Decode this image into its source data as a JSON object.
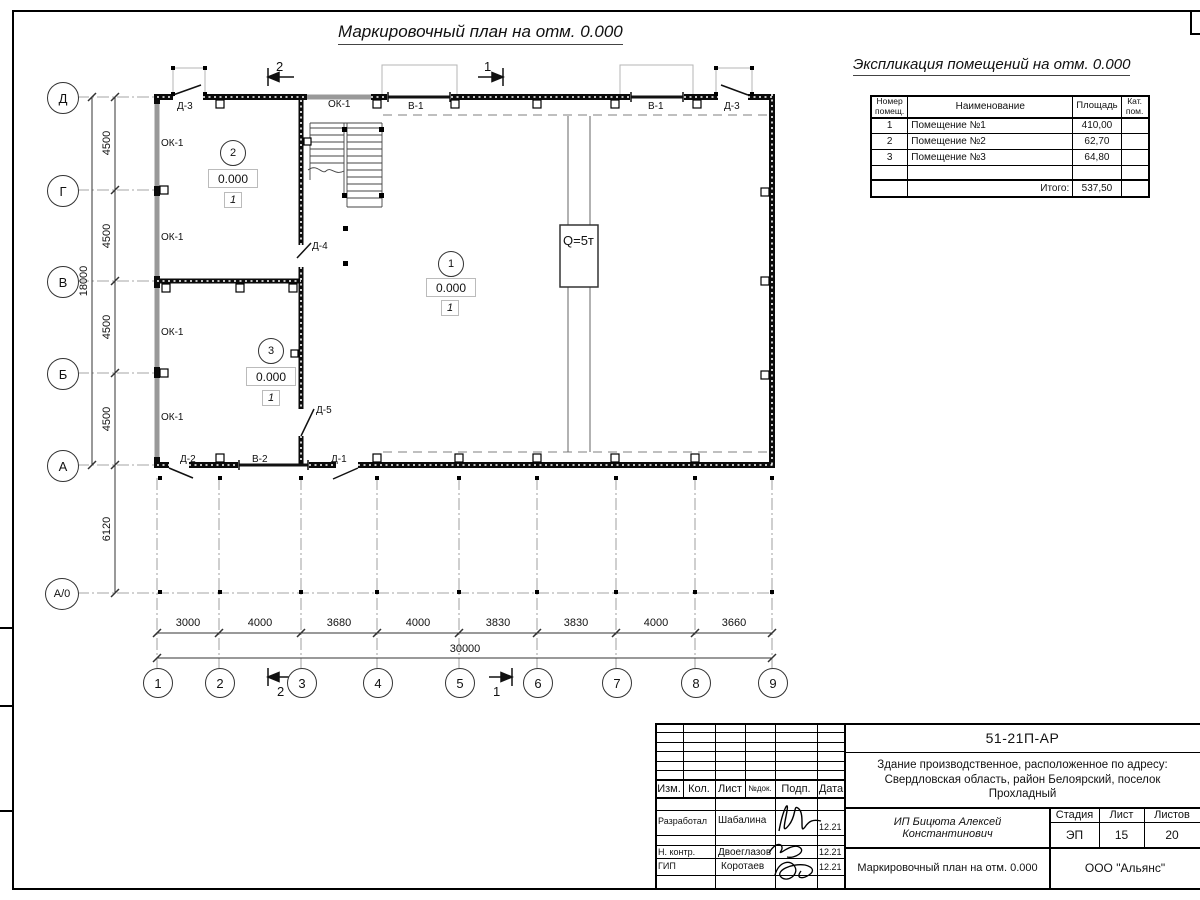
{
  "sheet": {
    "title": "Маркировочный план на отм. 0.000",
    "explication_title": "Экспликация помещений на отм. 0.000"
  },
  "explication": {
    "headers": {
      "num": "Номер помещ.",
      "name": "Наименование",
      "area": "Площадь",
      "cat": "Кат. пом."
    },
    "rows": [
      {
        "num": "1",
        "name": "Помещение №1",
        "area": "410,00",
        "cat": ""
      },
      {
        "num": "2",
        "name": "Помещение №2",
        "area": "62,70",
        "cat": ""
      },
      {
        "num": "3",
        "name": "Помещение №3",
        "area": "64,80",
        "cat": ""
      }
    ],
    "total_label": "Итого:",
    "total_area": "537,50"
  },
  "axes": {
    "rows": [
      "Д",
      "Г",
      "В",
      "Б",
      "А",
      "А/0"
    ],
    "cols": [
      "1",
      "2",
      "3",
      "4",
      "5",
      "6",
      "7",
      "8",
      "9"
    ]
  },
  "dims": {
    "left_bays": [
      "4500",
      "4500",
      "4500",
      "4500"
    ],
    "left_total": "18000",
    "left_offset": "6120",
    "bottom_bays": [
      "3000",
      "4000",
      "3680",
      "4000",
      "3830",
      "3830",
      "4000",
      "3660"
    ],
    "bottom_total": "30000"
  },
  "sections": {
    "s1": "1",
    "s2": "2"
  },
  "rooms": {
    "r1": {
      "num": "1",
      "elev": "0.000",
      "cat": "1"
    },
    "r2": {
      "num": "2",
      "elev": "0.000",
      "cat": "1"
    },
    "r3": {
      "num": "3",
      "elev": "0.000",
      "cat": "1"
    }
  },
  "labels": {
    "ok1": "ОК-1",
    "v1": "В-1",
    "v2": "В-2",
    "d1": "Д-1",
    "d2": "Д-2",
    "d3": "Д-3",
    "d4": "Д-4",
    "d5": "Д-5",
    "crane": "Q=5т"
  },
  "title_block": {
    "doc_number": "51-21П-АР",
    "project": "Здание производственное, расположенное по адресу: Свердловская область, район Белоярский, поселок Прохладный",
    "client": "ИП Бицюта Алексей Константинович",
    "drawing_name": "Маркировочный план на отм. 0.000",
    "company": "ООО \"Альянс\"",
    "stage_label": "Стадия",
    "sheet_label": "Лист",
    "sheets_label": "Листов",
    "stage": "ЭП",
    "sheet_num": "15",
    "sheets_total": "20",
    "cols": [
      "Изм.",
      "Кол.",
      "Лист",
      "№док.",
      "Подп.",
      "Дата"
    ],
    "staff": [
      {
        "role": "Разработал",
        "name": "Шабалина",
        "date": "12.21"
      },
      {
        "role": "Н. контр.",
        "name": "Двоеглазов",
        "date": "12.21"
      },
      {
        "role": "ГИП",
        "name": "Коротаев",
        "date": "12.21"
      }
    ]
  }
}
